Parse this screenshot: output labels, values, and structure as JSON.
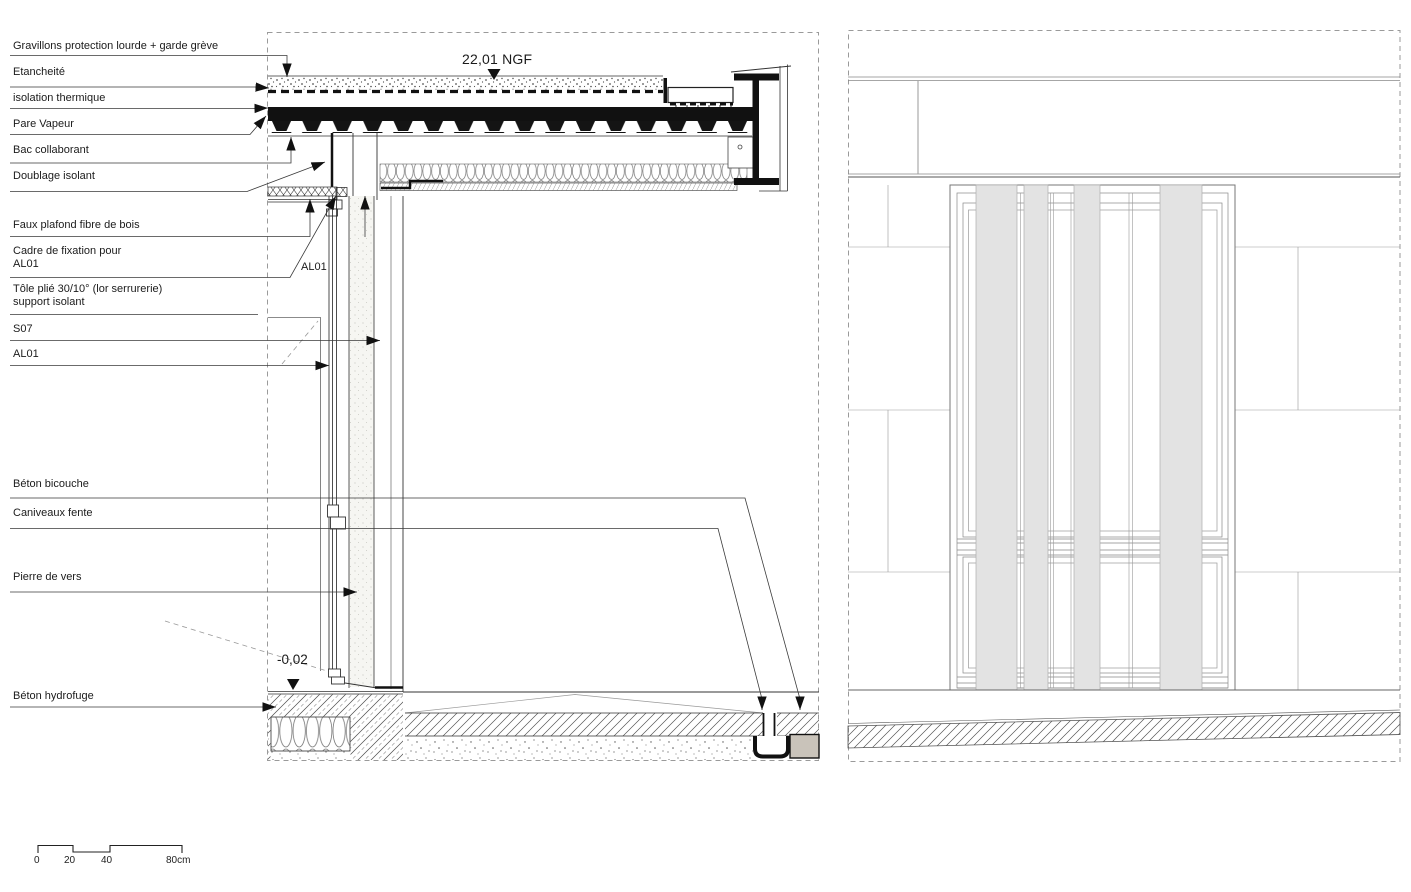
{
  "drawing": {
    "kind": "architectural construction detail — wall / roof / ground section with facade elevation"
  },
  "section_labels": [
    {
      "text": "Gravillons protection lourde + garde grève"
    },
    {
      "text": "Etancheité"
    },
    {
      "text": "isolation thermique"
    },
    {
      "text": "Pare Vapeur"
    },
    {
      "text": "Bac collaborant"
    },
    {
      "text": "Doublage isolant"
    },
    {
      "text": "Faux plafond fibre de bois"
    },
    {
      "text": "Cadre de fixation pour AL01"
    },
    {
      "text": "Tôle plié 30/10° (lor serrurerie) support isolant"
    },
    {
      "text": "S07"
    },
    {
      "text": "AL01"
    },
    {
      "text": "Béton bicouche"
    },
    {
      "text": "Caniveaux fente"
    },
    {
      "text": "Pierre de vers"
    },
    {
      "text": "Béton hydrofuge"
    }
  ],
  "annotations": {
    "roof_level": "22,01 NGF",
    "ground_level": "-0,02",
    "window_ref": "AL01"
  },
  "scale_bar": {
    "tick_0": "0",
    "tick_20": "20",
    "tick_40": "40",
    "tick_80": "80cm"
  },
  "colors": {
    "line": "#1a1a1a",
    "light_line": "#999999",
    "louver_stripe": "#e3e3e3",
    "drain_block": "#c9c3ba"
  }
}
